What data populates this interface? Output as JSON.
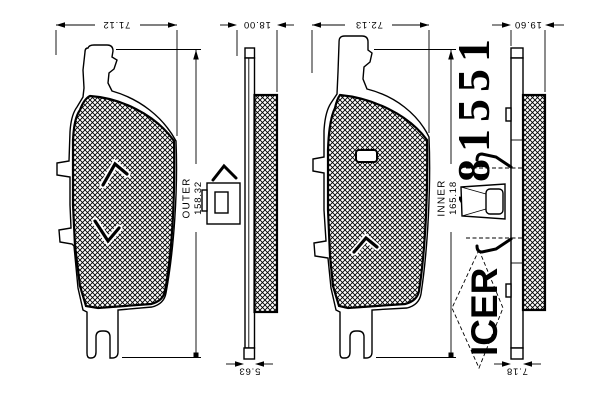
{
  "drawing": {
    "background_color": "#ffffff",
    "line_color": "#000000",
    "part_number": "181551",
    "brand": "ICER",
    "outer_view": {
      "label": "OUTER",
      "width": "71.12",
      "length": "158.32",
      "thickness": "18.00",
      "plate_thickness": "5.63"
    },
    "inner_view": {
      "label": "INNER",
      "width": "72.13",
      "length": "165.18",
      "thickness": "19.60",
      "plate_thickness": "7.18"
    }
  }
}
